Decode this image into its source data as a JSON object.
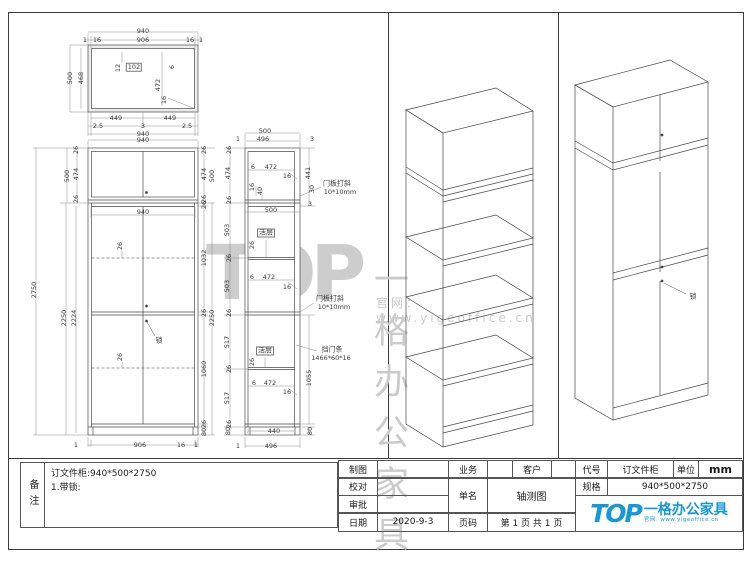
{
  "page": {
    "background": "#ffffff",
    "line_color": "#4a4a4a",
    "dim_color": "#3a3a3a",
    "accent_blue": "#1899d6",
    "watermark_gray": "#cccccc"
  },
  "watermark": {
    "logo": "TOP",
    "brand": "一格办公家具",
    "url": "官网：www.yigeoffice.cn"
  },
  "notes": {
    "label": "备注",
    "line1": "订文件柜:940*500*2750",
    "line2": "1.带锁:"
  },
  "title_block": {
    "drafter_label": "制图",
    "drafter": "",
    "checker_label": "校对",
    "checker": "",
    "approver_label": "审批",
    "approver": "",
    "date_label": "日期",
    "date": "2020-9-3",
    "business_label": "业务",
    "business": "",
    "customer_label": "客户",
    "customer": "",
    "name_label": "单名",
    "name": "轴测图",
    "page_label": "页码",
    "page": "第 1 页 共 1 页",
    "code_label": "代号",
    "code": "订文件柜",
    "unit_label": "单位",
    "unit": "mm",
    "spec_label": "规格",
    "spec": "940*500*2750"
  },
  "brand_logo": {
    "logo": "TOP",
    "brand": "一格办公家具",
    "url": "官网: www.yigeoffice.cn"
  },
  "labels": [
    {
      "t": "940",
      "x": 143,
      "y": 31
    },
    {
      "t": "1",
      "x": 85,
      "y": 40
    },
    {
      "t": "16",
      "x": 97,
      "y": 40
    },
    {
      "t": "906",
      "x": 143,
      "y": 40
    },
    {
      "t": "16",
      "x": 190,
      "y": 40
    },
    {
      "t": "1",
      "x": 201,
      "y": 40
    },
    {
      "t": "500",
      "x": 70,
      "y": 78,
      "r": -90
    },
    {
      "t": "468",
      "x": 81,
      "y": 78,
      "r": -90
    },
    {
      "t": "12",
      "x": 118,
      "y": 68,
      "r": -90
    },
    {
      "t": "102",
      "x": 134,
      "y": 67,
      "c": "box"
    },
    {
      "t": "6",
      "x": 172,
      "y": 67,
      "r": -90
    },
    {
      "t": "472",
      "x": 158,
      "y": 85,
      "r": -90
    },
    {
      "t": "16",
      "x": 164,
      "y": 100,
      "r": -90
    },
    {
      "t": "449",
      "x": 116,
      "y": 118
    },
    {
      "t": "449",
      "x": 170,
      "y": 118
    },
    {
      "t": "2.5",
      "x": 98,
      "y": 126
    },
    {
      "t": "3",
      "x": 143,
      "y": 126
    },
    {
      "t": "2.5",
      "x": 187,
      "y": 126
    },
    {
      "t": "940",
      "x": 143,
      "y": 134
    },
    {
      "t": "940",
      "x": 143,
      "y": 140
    },
    {
      "t": "26",
      "x": 76,
      "y": 150,
      "r": -90
    },
    {
      "t": "474",
      "x": 76,
      "y": 174,
      "r": -90
    },
    {
      "t": "500",
      "x": 67,
      "y": 176,
      "r": -90
    },
    {
      "t": "26",
      "x": 76,
      "y": 199,
      "r": -90
    },
    {
      "t": "26",
      "x": 204,
      "y": 150,
      "r": -90
    },
    {
      "t": "474",
      "x": 204,
      "y": 174,
      "r": -90
    },
    {
      "t": "500",
      "x": 212,
      "y": 176,
      "r": -90
    },
    {
      "t": "26",
      "x": 204,
      "y": 199,
      "r": -90
    },
    {
      "t": "940",
      "x": 143,
      "y": 212
    },
    {
      "t": "2750",
      "x": 34,
      "y": 290,
      "r": -90
    },
    {
      "t": "2250",
      "x": 64,
      "y": 318,
      "r": -90
    },
    {
      "t": "2224",
      "x": 74,
      "y": 318,
      "r": -90
    },
    {
      "t": "26",
      "x": 204,
      "y": 205,
      "r": -90
    },
    {
      "t": "1032",
      "x": 204,
      "y": 258,
      "r": -90
    },
    {
      "t": "26",
      "x": 204,
      "y": 313,
      "r": -90
    },
    {
      "t": "1060",
      "x": 204,
      "y": 369,
      "r": -90
    },
    {
      "t": "26",
      "x": 204,
      "y": 424,
      "r": -90
    },
    {
      "t": "80",
      "x": 204,
      "y": 432,
      "r": -90
    },
    {
      "t": "2250",
      "x": 212,
      "y": 318,
      "r": -90
    },
    {
      "t": "26",
      "x": 120,
      "y": 246,
      "r": -90
    },
    {
      "t": "26",
      "x": 120,
      "y": 357,
      "r": -90
    },
    {
      "t": "锁",
      "x": 159,
      "y": 341,
      "c": "cn"
    },
    {
      "t": "1",
      "x": 76,
      "y": 445
    },
    {
      "t": "906",
      "x": 140,
      "y": 445
    },
    {
      "t": "16",
      "x": 181,
      "y": 445
    },
    {
      "t": "1",
      "x": 196,
      "y": 445
    },
    {
      "t": "500",
      "x": 265,
      "y": 131
    },
    {
      "t": "1",
      "x": 238,
      "y": 139
    },
    {
      "t": "496",
      "x": 263,
      "y": 139
    },
    {
      "t": "3",
      "x": 312,
      "y": 139
    },
    {
      "t": "26",
      "x": 229,
      "y": 150,
      "r": -90
    },
    {
      "t": "474",
      "x": 228,
      "y": 173,
      "r": -90
    },
    {
      "t": "26",
      "x": 229,
      "y": 200,
      "r": -90
    },
    {
      "t": "503",
      "x": 227,
      "y": 230,
      "r": -90
    },
    {
      "t": "26",
      "x": 229,
      "y": 258,
      "r": -90
    },
    {
      "t": "503",
      "x": 227,
      "y": 286,
      "r": -90
    },
    {
      "t": "26",
      "x": 229,
      "y": 313,
      "r": -90
    },
    {
      "t": "517",
      "x": 227,
      "y": 342,
      "r": -90
    },
    {
      "t": "26",
      "x": 229,
      "y": 369,
      "r": -90
    },
    {
      "t": "517",
      "x": 227,
      "y": 398,
      "r": -90
    },
    {
      "t": "26",
      "x": 229,
      "y": 424,
      "r": -90
    },
    {
      "t": "80",
      "x": 228,
      "y": 431,
      "r": -90
    },
    {
      "t": "6",
      "x": 253,
      "y": 167
    },
    {
      "t": "472",
      "x": 271,
      "y": 167
    },
    {
      "t": "16",
      "x": 287,
      "y": 176
    },
    {
      "t": "16",
      "x": 252,
      "y": 187,
      "r": -90
    },
    {
      "t": "40",
      "x": 260,
      "y": 191,
      "r": -90
    },
    {
      "t": "441",
      "x": 308,
      "y": 173,
      "r": -90
    },
    {
      "t": "30",
      "x": 312,
      "y": 189,
      "r": -90
    },
    {
      "t": "3",
      "x": 310,
      "y": 204
    },
    {
      "t": "门板打斜",
      "x": 337,
      "y": 184,
      "c": "cn"
    },
    {
      "t": "10*10mm",
      "x": 340,
      "y": 192
    },
    {
      "t": "500",
      "x": 271,
      "y": 210
    },
    {
      "t": "活层",
      "x": 266,
      "y": 233,
      "c": "box cn"
    },
    {
      "t": "26",
      "x": 252,
      "y": 245,
      "r": -90
    },
    {
      "t": "6",
      "x": 252,
      "y": 277
    },
    {
      "t": "472",
      "x": 269,
      "y": 277
    },
    {
      "t": "16",
      "x": 287,
      "y": 287
    },
    {
      "t": "门板打斜",
      "x": 330,
      "y": 299,
      "c": "cn"
    },
    {
      "t": "10*10mm",
      "x": 334,
      "y": 307
    },
    {
      "t": "活层",
      "x": 265,
      "y": 351,
      "c": "box cn"
    },
    {
      "t": "26",
      "x": 252,
      "y": 362,
      "r": -90
    },
    {
      "t": "6",
      "x": 254,
      "y": 383
    },
    {
      "t": "472",
      "x": 270,
      "y": 383
    },
    {
      "t": "16",
      "x": 287,
      "y": 392
    },
    {
      "t": "挡门条",
      "x": 332,
      "y": 350,
      "c": "cn"
    },
    {
      "t": "1466*60*16",
      "x": 331,
      "y": 358
    },
    {
      "t": "1055",
      "x": 309,
      "y": 378,
      "r": -90
    },
    {
      "t": "80",
      "x": 310,
      "y": 431,
      "r": -90
    },
    {
      "t": "440",
      "x": 274,
      "y": 431
    },
    {
      "t": "496",
      "x": 271,
      "y": 446
    },
    {
      "t": "1",
      "x": 238,
      "y": 446
    },
    {
      "t": "锁",
      "x": 693,
      "y": 297,
      "c": "cn"
    }
  ]
}
